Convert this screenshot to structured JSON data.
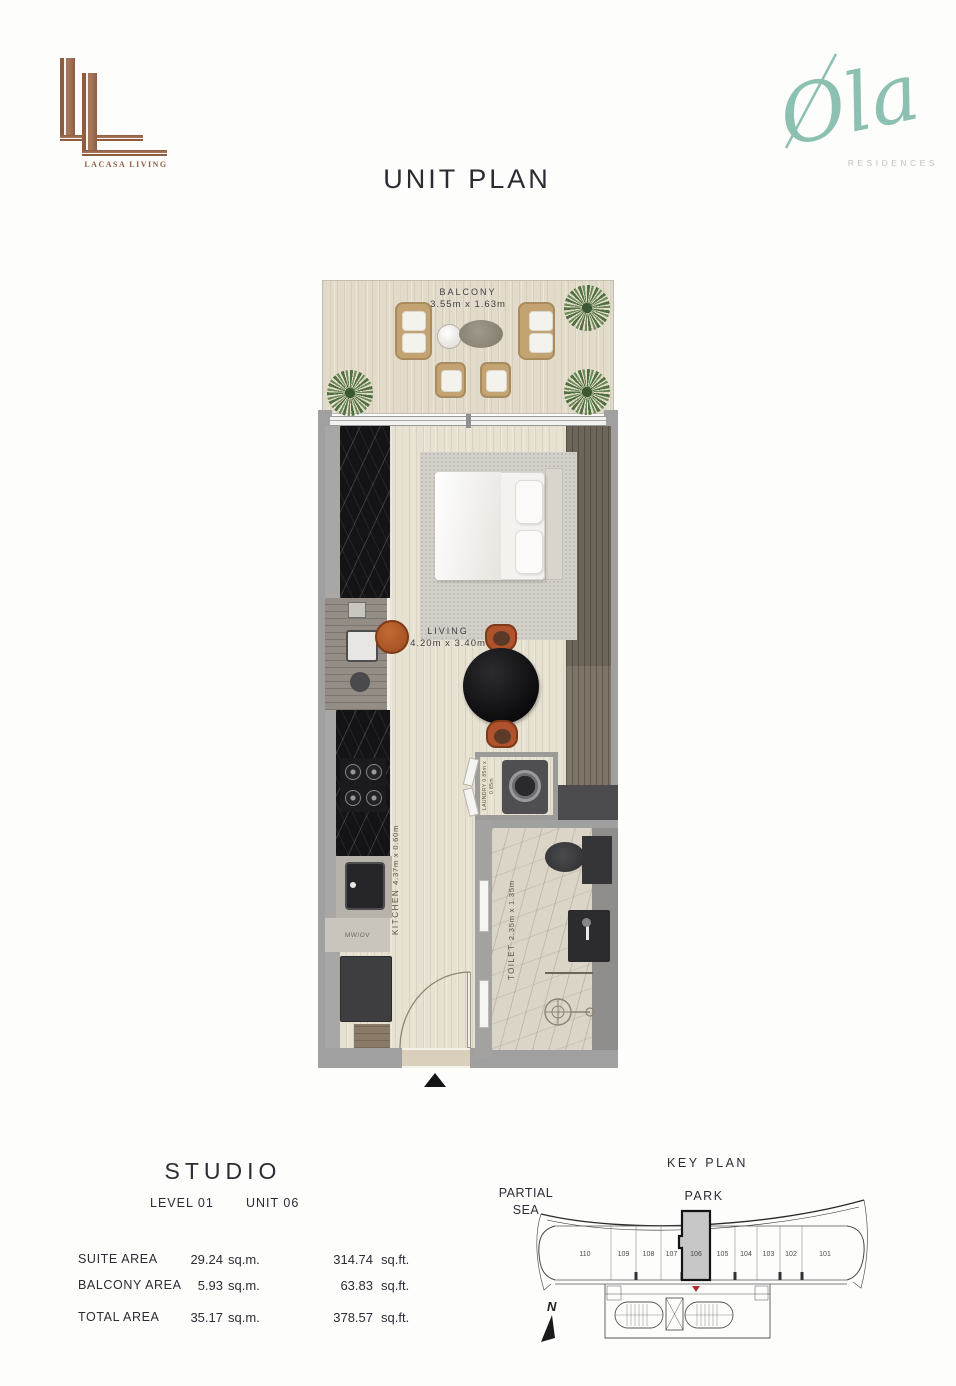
{
  "page": {
    "title": "UNIT PLAN"
  },
  "brand_left": {
    "name": "LACASA LIVING"
  },
  "brand_right": {
    "name": "Ola",
    "subtitle": "RESIDENCES"
  },
  "floor_plan": {
    "balcony": {
      "label": "BALCONY",
      "dims": "3.55m x 1.63m"
    },
    "living": {
      "label": "LIVING",
      "dims": "4.20m x 3.40m"
    },
    "kitchen": {
      "label": "KITCHEN",
      "dims": "4.37m x 0.60m"
    },
    "toilet": {
      "label": "TOILET",
      "dims": "2.35m x 1.35m"
    },
    "laundry": {
      "label": "LAUNDRY",
      "dims": "0.85m x 0.85m"
    },
    "appliance_label": "MW/OV"
  },
  "unit_info": {
    "type": "STUDIO",
    "level": "LEVEL 01",
    "unit": "UNIT 06",
    "areas": [
      {
        "name": "SUITE AREA",
        "sqm": "29.24",
        "sqm_unit": "sq.m.",
        "sqft": "314.74",
        "sqft_unit": "sq.ft."
      },
      {
        "name": "BALCONY AREA",
        "sqm": "5.93",
        "sqm_unit": "sq.m.",
        "sqft": "63.83",
        "sqft_unit": "sq.ft."
      },
      {
        "name": "TOTAL AREA",
        "sqm": "35.17",
        "sqm_unit": "sq.m.",
        "sqft": "378.57",
        "sqft_unit": "sq.ft."
      }
    ]
  },
  "key_plan": {
    "title": "KEY PLAN",
    "sea_label_line1": "PARTIAL",
    "sea_label_line2": "SEA",
    "park_label": "PARK",
    "north_label": "N",
    "highlighted_unit": "106",
    "units": [
      "110",
      "109",
      "108",
      "107",
      "106",
      "105",
      "104",
      "103",
      "102",
      "101"
    ]
  },
  "colors": {
    "copper": "#96654a",
    "teal": "#8cc0b1",
    "text_dark": "#2b2b33",
    "wall_gray": "#a0a0a1",
    "floor_cream": "#e7e1d1",
    "highlight_gray": "#c7c7c7",
    "marker_red": "#b03030",
    "accent_orange": "#b0522b"
  }
}
